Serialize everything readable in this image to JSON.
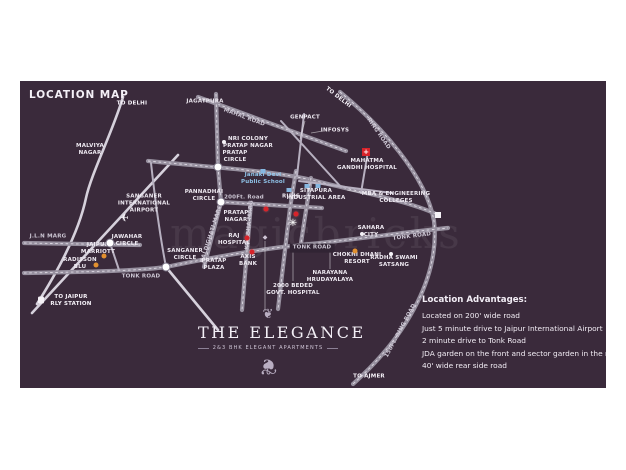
{
  "map": {
    "title": "LOCATION MAP",
    "watermark": "magicbricks",
    "colors": {
      "background": "#3a2a3b",
      "road": "#97909f",
      "road_dash": "#ded9e3",
      "light_road": "#d6d1dc",
      "label": "#efeaf2",
      "blue_label": "#8fc3e8",
      "red_marker": "#d8232a",
      "orange_marker": "#e2902f"
    },
    "labels": [
      {
        "name": "label-to-delhi-west",
        "text": "TO DELHI",
        "x": 112,
        "y": 23,
        "cls": "dir"
      },
      {
        "name": "label-jagatpura",
        "text": "JAGATPURA",
        "x": 185,
        "y": 21,
        "cls": "poi"
      },
      {
        "name": "label-mahal-road",
        "text": "MAHAL ROAD",
        "x": 224,
        "y": 37,
        "cls": "road",
        "rot": 20
      },
      {
        "name": "label-to-delhi-east",
        "text": "TO DELHI",
        "x": 318,
        "y": 17,
        "cls": "dir",
        "rot": 38
      },
      {
        "name": "label-genpact",
        "text": "GENPACT",
        "x": 285,
        "y": 37,
        "cls": "poi"
      },
      {
        "name": "label-infosys",
        "text": "INFOSYS",
        "x": 315,
        "y": 50,
        "cls": "poi"
      },
      {
        "name": "label-ring-road",
        "text": "RING ROAD",
        "x": 358,
        "y": 53,
        "cls": "road",
        "rot": 55
      },
      {
        "name": "label-malviya-nagar",
        "text": "MALVIYA\nNAGAR",
        "x": 70,
        "y": 69,
        "cls": "poi"
      },
      {
        "name": "label-nri-colony",
        "text": "NRI COLONY\nPRATAP NAGAR",
        "x": 228,
        "y": 62,
        "cls": "poi"
      },
      {
        "name": "label-pratap-circle",
        "text": "PRATAP\nCIRCLE",
        "x": 215,
        "y": 76,
        "cls": "poi"
      },
      {
        "name": "label-mahatma-gandhi-hospital",
        "text": "MAHATMA\nGANDHI HOSPITAL",
        "x": 347,
        "y": 84,
        "cls": "poi"
      },
      {
        "name": "label-sanganer-airport",
        "text": "SANGANER\nINTERNATIONAL\nAIRPORT",
        "x": 124,
        "y": 123,
        "cls": "poi"
      },
      {
        "name": "label-pannadhai-circle",
        "text": "PANNADHAI\nCIRCLE",
        "x": 184,
        "y": 115,
        "cls": "poi"
      },
      {
        "name": "label-200ft-road",
        "text": "200Ft. Road",
        "x": 224,
        "y": 117,
        "cls": "road"
      },
      {
        "name": "label-pratap-nagar",
        "text": "PRATAP\nNAGAR",
        "x": 216,
        "y": 136,
        "cls": "poi"
      },
      {
        "name": "label-kumbha-marg",
        "text": "KUMBHA MARG",
        "x": 230,
        "y": 144,
        "cls": "road",
        "rot": -85
      },
      {
        "name": "label-haldighati-marg",
        "text": "HALDIGHATI MARG",
        "x": 192,
        "y": 153,
        "cls": "road",
        "rot": -72
      },
      {
        "name": "label-janaki-devi-school",
        "text": "Janaki Devi\nPublic School",
        "x": 243,
        "y": 98,
        "cls": "poi-blue"
      },
      {
        "name": "label-ruhs",
        "text": "RUHS",
        "x": 271,
        "y": 116,
        "cls": "poi"
      },
      {
        "name": "label-sitapura-industrial",
        "text": "SITAPURA\nINDUSTRIAL AREA",
        "x": 296,
        "y": 114,
        "cls": "poi"
      },
      {
        "name": "label-mba-colleges",
        "text": "MBA & ENGINEERING\nCOLLEGES",
        "x": 376,
        "y": 117,
        "cls": "poi"
      },
      {
        "name": "label-sahara-city",
        "text": "SAHARA\nCITY",
        "x": 351,
        "y": 151,
        "cls": "poi"
      },
      {
        "name": "label-jln-marg",
        "text": "J.L.N MARG",
        "x": 28,
        "y": 156,
        "cls": "road"
      },
      {
        "name": "label-jawahar-circle",
        "text": "JAWAHAR\nCIRCLE",
        "x": 107,
        "y": 160,
        "cls": "poi"
      },
      {
        "name": "label-jaipur-marriott",
        "text": "JAIPUR\nMARRIOTT",
        "x": 78,
        "y": 168,
        "cls": "poi"
      },
      {
        "name": "label-radisson-blu",
        "text": "RADISSON\nBLU",
        "x": 60,
        "y": 183,
        "cls": "poi"
      },
      {
        "name": "label-sanganer-circle",
        "text": "SANGANER\nCIRCLE",
        "x": 165,
        "y": 174,
        "cls": "poi"
      },
      {
        "name": "label-pratap-plaza",
        "text": "PRATAP\nPLAZA",
        "x": 194,
        "y": 184,
        "cls": "poi"
      },
      {
        "name": "label-tonk-road-west",
        "text": "TONK ROAD",
        "x": 121,
        "y": 196,
        "cls": "road"
      },
      {
        "name": "label-tonk-road-center",
        "text": "TONK ROAD",
        "x": 292,
        "y": 167,
        "cls": "onroad road"
      },
      {
        "name": "label-tonk-road-east",
        "text": "TONK ROAD",
        "x": 392,
        "y": 156,
        "cls": "road",
        "rot": -7
      },
      {
        "name": "label-raj-hospital",
        "text": "RAJ\nHOSPITAL",
        "x": 214,
        "y": 159,
        "cls": "poi"
      },
      {
        "name": "label-axis-bank",
        "text": "AXIS\nBANK",
        "x": 228,
        "y": 180,
        "cls": "poi"
      },
      {
        "name": "label-govt-hospital",
        "text": "2000 BEDED\nGOVT. HOSPITAL",
        "x": 273,
        "y": 209,
        "cls": "poi"
      },
      {
        "name": "label-narayana-hrudayalaya",
        "text": "NARAYANA\nHRUDAYALAYA",
        "x": 310,
        "y": 196,
        "cls": "poi"
      },
      {
        "name": "label-chokhi-dhani",
        "text": "CHOKHI DHANI\nRESORT",
        "x": 337,
        "y": 178,
        "cls": "poi"
      },
      {
        "name": "label-radha-swami",
        "text": "RADHA SWAMI\nSATSANG",
        "x": 374,
        "y": 181,
        "cls": "poi"
      },
      {
        "name": "label-to-jaipur-rly",
        "text": "TO JAIPUR\nRLY STATION",
        "x": 51,
        "y": 220,
        "cls": "dir"
      },
      {
        "name": "label-to-ajmer",
        "text": "TO AJMER",
        "x": 349,
        "y": 296,
        "cls": "dir"
      },
      {
        "name": "label-150ft-ring-road",
        "text": "150Ft. RING ROAD",
        "x": 381,
        "y": 250,
        "cls": "road",
        "rot": -62
      }
    ],
    "markers": [
      {
        "name": "nri-colony-dot",
        "kind": "white-dot",
        "x": 204,
        "y": 61
      },
      {
        "name": "pratap-circle-node",
        "kind": "node-circle",
        "x": 198,
        "y": 86
      },
      {
        "name": "pannadhai-circle-node",
        "kind": "node-circle",
        "x": 201,
        "y": 121
      },
      {
        "name": "jawahar-circle-node",
        "kind": "node-circle",
        "x": 90,
        "y": 162
      },
      {
        "name": "sanganer-circle-node",
        "kind": "node-circle",
        "x": 146,
        "y": 186
      },
      {
        "name": "mahatma-gandhi-hospital-marker",
        "kind": "red-cross",
        "x": 346,
        "y": 71
      },
      {
        "name": "factory-icon",
        "kind": "blue-sq",
        "x": 287,
        "y": 105
      },
      {
        "name": "factory-icon",
        "kind": "blue-sq",
        "x": 298,
        "y": 105
      },
      {
        "name": "school-marker",
        "kind": "blue-sq",
        "x": 243,
        "y": 90
      },
      {
        "name": "ruhs-marker",
        "kind": "blue-sq",
        "x": 269,
        "y": 109
      },
      {
        "name": "pratap-nagar-marker",
        "kind": "red-dot",
        "x": 246,
        "y": 128
      },
      {
        "name": "project-area-marker",
        "kind": "red-dot",
        "x": 276,
        "y": 133
      },
      {
        "name": "project-location-star",
        "kind": "star",
        "x": 273,
        "y": 143
      },
      {
        "name": "raj-hospital-marker",
        "kind": "red-dot",
        "x": 227,
        "y": 157
      },
      {
        "name": "axis-bank-marker",
        "kind": "red-dot",
        "x": 232,
        "y": 171
      },
      {
        "name": "jaipur-marriott-marker",
        "kind": "orange-dot",
        "x": 84,
        "y": 175
      },
      {
        "name": "radisson-blu-marker",
        "kind": "orange-dot",
        "x": 76,
        "y": 184
      },
      {
        "name": "sahara-city-marker",
        "kind": "white-dot",
        "x": 342,
        "y": 153
      },
      {
        "name": "chokhi-dhani-marker",
        "kind": "orange-dot",
        "x": 335,
        "y": 170
      },
      {
        "name": "radha-swami-marker",
        "kind": "white-dot",
        "x": 371,
        "y": 173
      },
      {
        "name": "ring-junction-marker",
        "kind": "white-square",
        "x": 418,
        "y": 134
      },
      {
        "name": "airport-plane-icon",
        "kind": "plane",
        "x": 104,
        "y": 137
      },
      {
        "name": "railway-station-icon",
        "kind": "train",
        "x": 21,
        "y": 219
      },
      {
        "name": "logo-hanger-diamond",
        "kind": "diamond",
        "x": 245,
        "y": 157
      }
    ]
  },
  "logo": {
    "title": "THE ELEGANCE",
    "subtitle": "2&3 BHK ELEGANT APARTMENTS"
  },
  "advantages": {
    "title": "Location Advantages:",
    "items": [
      "Located on 200' wide road",
      "Just 5 minute drive to Jaipur International Airport",
      "2 minute drive to Tonk Road",
      "JDA garden on the front and sector garden in the rear",
      "40' wide rear side road"
    ]
  }
}
